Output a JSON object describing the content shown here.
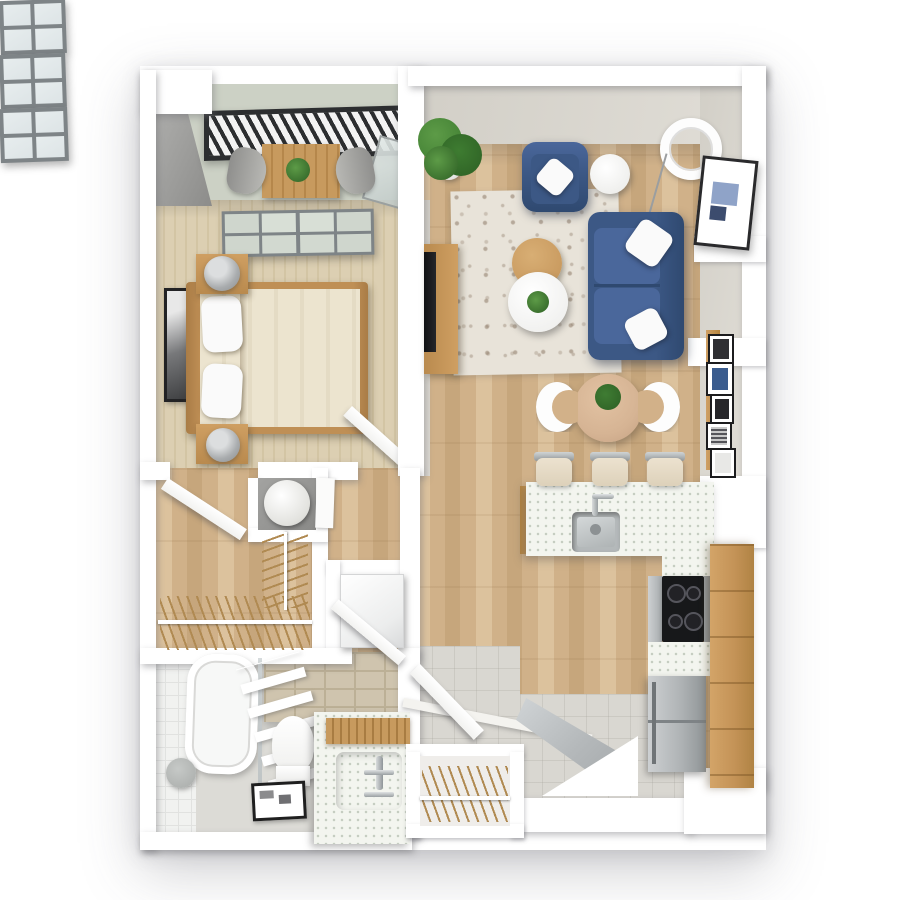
{
  "scene": {
    "description": "photorealistic 3D top-down floor plan render of a one-bedroom apartment on a white background",
    "background": "#ffffff",
    "visible_text": []
  },
  "palette": {
    "bg": "#ffffff",
    "wall": "#ffffff",
    "faceGreigeA": "#d2cfc7",
    "faceGreigeB": "#e0ddd6",
    "grayA": "#b2b2b0",
    "grayB": "#8c8c8a",
    "woodA": "#dcc29d",
    "woodB": "#d0b189",
    "woodC": "#c6a67c",
    "carpet": "#dccfb2",
    "carpetLine": "#d3c5a4",
    "balconyFloor": "#ccd1c5",
    "rugBase": "#e8e3d9",
    "rugMotif": "#8d7a67",
    "sofaBlue": "#3c5885",
    "sofaBlueLight": "#4a679b",
    "sofaBlueDark": "#2f4970",
    "pillow": "#fafafa",
    "cabinetWood": "#c49357",
    "cabinetSeam": "#9a7138",
    "counter": "#f3f5ef",
    "speck": "#c4ccc0",
    "steel": "#b9bdbf",
    "steelDark": "#8f9598",
    "cooktop": "#17181a",
    "burner": "#55555c",
    "tileBeige": "#cfc4ae",
    "tileBeigeGrout": "#bcb096",
    "bathFloor": "#dcdbd6",
    "tileWhite": "#f1f2f0",
    "tileWhiteGrout": "#e1e2e0",
    "entryTile": "#d9d7d1",
    "glass": "#dde4e6",
    "glassGreen": "#cfd6cd",
    "frameGray": "#7e8487",
    "rail": "#2c2e30",
    "doorGray": "#c3c7c9",
    "hanger": "#b08a52",
    "plant": "#3e7c31",
    "plantDark": "#2d5f24",
    "plantLight": "#5d9b47",
    "lampGray": "#a9acae",
    "artFrame": "#232325",
    "tableTan": "#d6b494",
    "chairWhite": "#fdfdfd",
    "mat": "#1f1f1f"
  },
  "rooms": {
    "balcony": {
      "items": [
        "black-slat-railing",
        "outdoor-table",
        "potted-plant",
        "outdoor-chair-left",
        "outdoor-chair-right",
        "glass-balustrade"
      ]
    },
    "bedroom": {
      "items": [
        "sliding-glass-door",
        "double-bed",
        "pillow",
        "pillow",
        "nightstand",
        "nightstand",
        "table-lamp",
        "table-lamp",
        "framed-wall-art",
        "door"
      ],
      "counts": {
        "pillows": 2,
        "nightstands": 2,
        "lamps": 2
      }
    },
    "walk_in_closet": {
      "items": [
        "open-door",
        "hanger-rail-bottom",
        "hanger-rail-side",
        "water-heater"
      ]
    },
    "laundry_nook": {
      "items": [
        "washing-machine"
      ]
    },
    "bathroom": {
      "items": [
        "bathtub",
        "shower-screen",
        "towel-ladder",
        "toilet",
        "floor-drain-mat",
        "vanity-counter",
        "wood-tray",
        "faucet",
        "stool"
      ]
    },
    "entry": {
      "items": [
        "front-door",
        "doorway-light",
        "step-edge",
        "interior-door",
        "coat-closet",
        "coat-hangers"
      ]
    },
    "living_room": {
      "items": [
        "window",
        "window",
        "window",
        "potted-plant",
        "armchair",
        "throw-pillow",
        "side-table",
        "arc-floor-lamp",
        "sofa",
        "throw-pillow",
        "throw-pillow",
        "area-rug",
        "round-coffee-table-wood",
        "round-coffee-table-white",
        "coffee-table-plant",
        "tv-console",
        "tv",
        "framed-wall-art"
      ],
      "counts": {
        "windows": 3,
        "sofa_pillows": 2
      }
    },
    "dining_area": {
      "items": [
        "round-dining-table",
        "centerpiece-plant",
        "dining-chair",
        "dining-chair",
        "gallery-wall-frames"
      ],
      "counts": {
        "chairs": 2,
        "gallery_frames": 5
      }
    },
    "kitchen": {
      "items": [
        "island-counter",
        "sink",
        "faucet",
        "bar-stool",
        "bar-stool",
        "bar-stool",
        "cooktop",
        "oven-panel",
        "appliance-front",
        "refrigerator",
        "tall-wood-cabinets",
        "counter-run"
      ],
      "counts": {
        "bar_stools": 3,
        "burners": 4
      }
    }
  }
}
